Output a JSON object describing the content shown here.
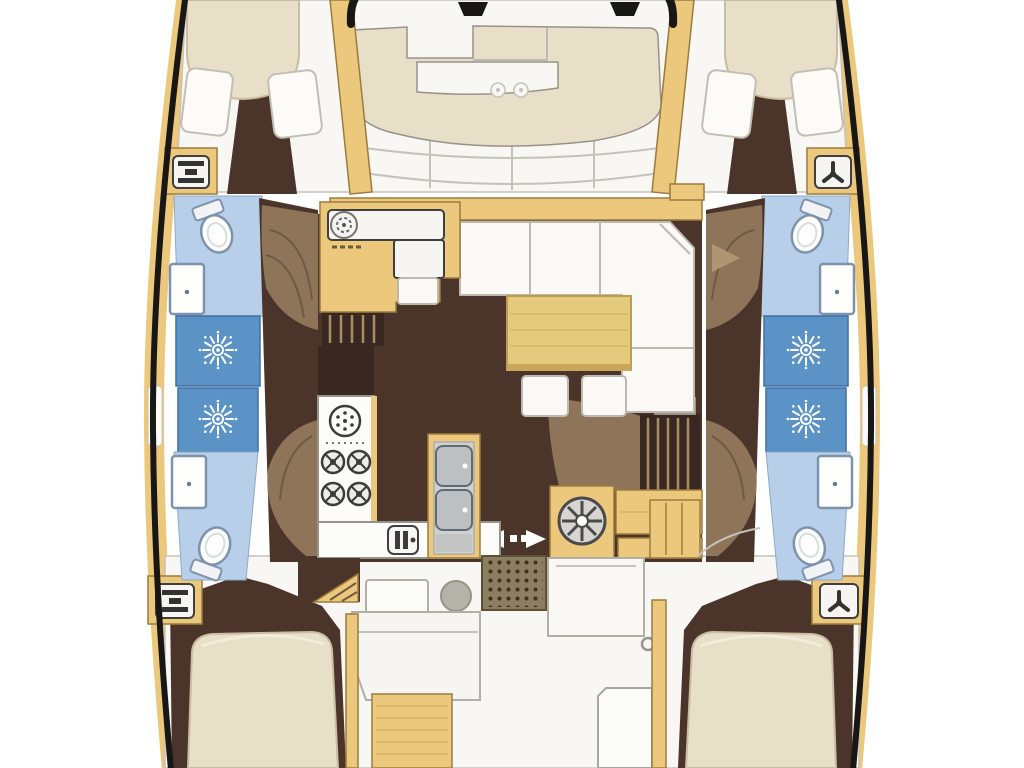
{
  "meta": {
    "title": "Catamaran interior floor plan",
    "view": "overhead-floor-plan",
    "vessel_type": "catamaran"
  },
  "colors": {
    "background": "#ffffff",
    "hull_outline": "#181715",
    "wood": "#ebc87c",
    "wood_edge": "#9c7c3f",
    "wood_grain": "#d9b264",
    "floor_dark": "#4b3429",
    "floor_dark2": "#382821",
    "floor_mid": "#8e755a",
    "floor_light": "#af9573",
    "step_line": "#6e5a42",
    "deck_white": "#f8f7f3",
    "deck_line": "#c6c2ba",
    "cushion": "#e8dfc9",
    "cushion_edge": "#c9bca2",
    "pillow": "#fcfbf8",
    "pillow_edge": "#c2beb4",
    "sofa": "#faf9f5",
    "sofa_line": "#bdb9b0",
    "table": "#e4ca7e",
    "table_edge": "#bb9c50",
    "bath": "#b7cfe9",
    "bath_edge": "#8fa9c6",
    "shower": "#5c93c7",
    "shower_edge": "#3f6f9f",
    "fixture": "#fdfdfb",
    "fixture_edge": "#7d93ad",
    "counter": "#fcfcfa",
    "counter_edge": "#97938b",
    "sink_gray": "#bcc0c3",
    "appliance": "#3c3c3c",
    "steps": "#8d7e62",
    "steps_dot": "#40331f",
    "seat_gray": "#b5b2aa",
    "arrow": "#ffffff"
  },
  "rooms": [
    "foredeck-lounge",
    "port-bow-cabin",
    "starboard-bow-cabin",
    "salon",
    "galley",
    "port-forward-head",
    "port-shower",
    "port-aft-head",
    "starboard-forward-head",
    "starboard-shower",
    "starboard-aft-head",
    "aft-cockpit",
    "port-aft-cabin",
    "starboard-aft-cabin"
  ],
  "fixtures": [
    "island-berth",
    "pillows",
    "l-shaped-sofa",
    "salon-table",
    "ottomans",
    "round-sink",
    "four-burner-stove",
    "double-sink-unit",
    "toilet",
    "shower-rose",
    "wheel",
    "companionway-steps",
    "sliding-door-arrows",
    "cup-holders",
    "deck-hatch",
    "vent-hatch",
    "anchor-crossbeam"
  ]
}
